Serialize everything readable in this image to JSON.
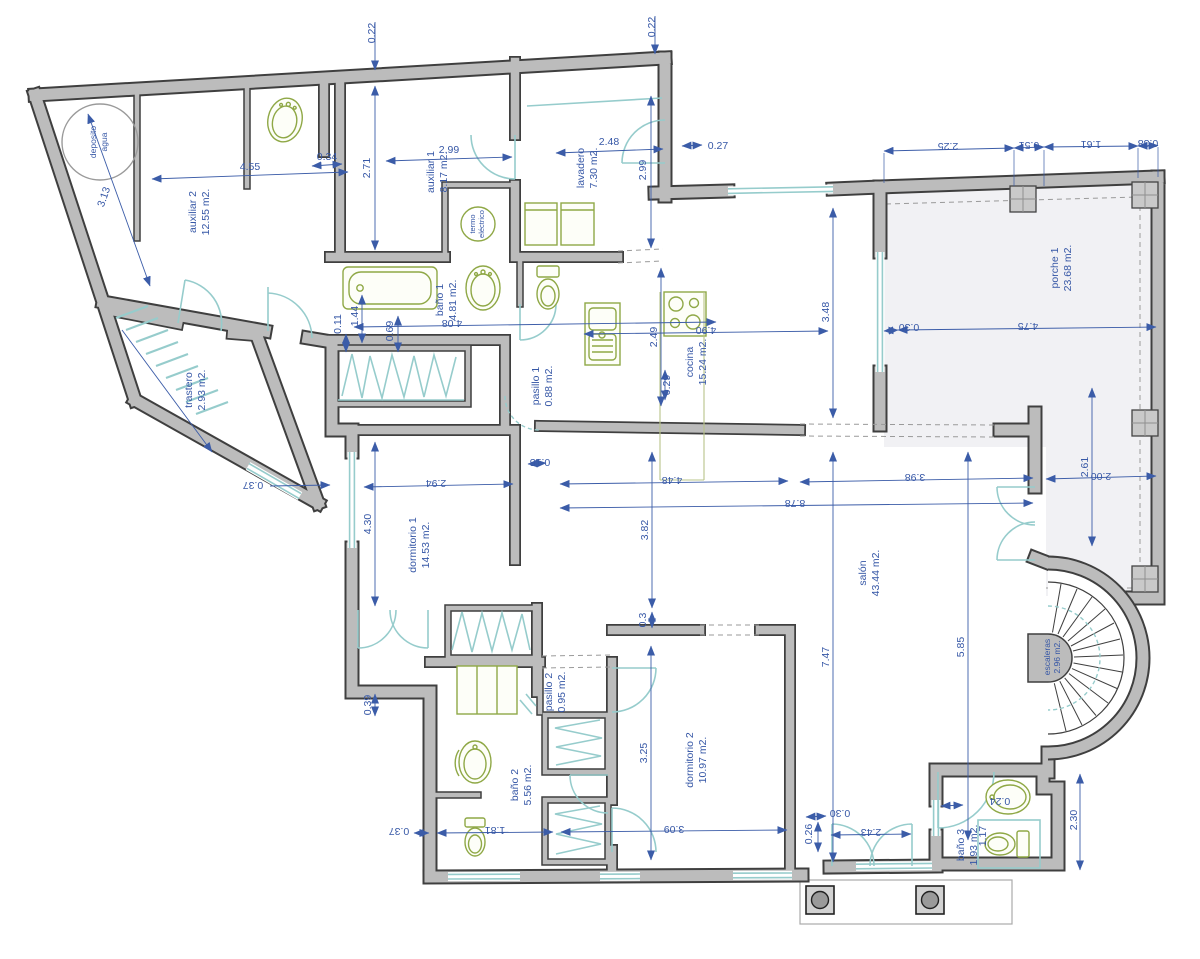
{
  "title": "floor-plan",
  "rooms": [
    {
      "name": "auxiliar 2",
      "area": "12.55 m2."
    },
    {
      "name": "auxiliar 1",
      "area": "8.17 m2."
    },
    {
      "name": "lavadero",
      "area": "7.30 m2."
    },
    {
      "name": "trastero",
      "area": "2.93 m2."
    },
    {
      "name": "baño 1",
      "area": "4.81 m2."
    },
    {
      "name": "pasillo 1",
      "area": "0.88 m2."
    },
    {
      "name": "cocina",
      "area": "15.24 m2."
    },
    {
      "name": "porche 1",
      "area": "23.68 m2."
    },
    {
      "name": "dormitorio 1",
      "area": "14.53 m2."
    },
    {
      "name": "pasillo 2",
      "area": "0.95 m2."
    },
    {
      "name": "baño 2",
      "area": "5.56 m2."
    },
    {
      "name": "dormitorio 2",
      "area": "10.97 m2."
    },
    {
      "name": "salón",
      "area": "43.44 m2."
    },
    {
      "name": "baño 3",
      "area": "1.93 m2."
    },
    {
      "name": "escaleras",
      "area": "2.96 m2."
    }
  ],
  "deposito": {
    "line1": "deposito",
    "line2": "agua"
  },
  "termo": {
    "line1": "termo",
    "line2": "eléctrico"
  },
  "dims": [
    "0.22",
    "0.22",
    "4.55",
    "0.34",
    "2.71",
    "2.99",
    "2.48",
    "2.99",
    "0.27",
    "3.13",
    "2.25",
    "0.51",
    "1.61",
    "0.38",
    "3.48",
    "4.90",
    "0.30",
    "4.75",
    "2.49",
    "0.29",
    "4.08",
    "0.11",
    "1.44",
    "0.69",
    "0.15",
    "2.94",
    "4.48",
    "8.78",
    "3.98",
    "0.37",
    "4.30",
    "3.82",
    "0.3",
    "7.47",
    "5.85",
    "2.61",
    "2.00",
    "0.39",
    "3.25",
    "0.37",
    "1.81",
    "3.09",
    "0.30",
    "0.26",
    "2.43",
    "0.24",
    "1.17",
    "2.30"
  ],
  "colors": {
    "wall": "#bcbcbc",
    "wall_outline": "#3f3f3f",
    "dimension_blue": "#3657a6",
    "fixture_green": "#8fa846",
    "door_window_teal": "#96cccc",
    "porch_fill": "#f1f1f4"
  }
}
